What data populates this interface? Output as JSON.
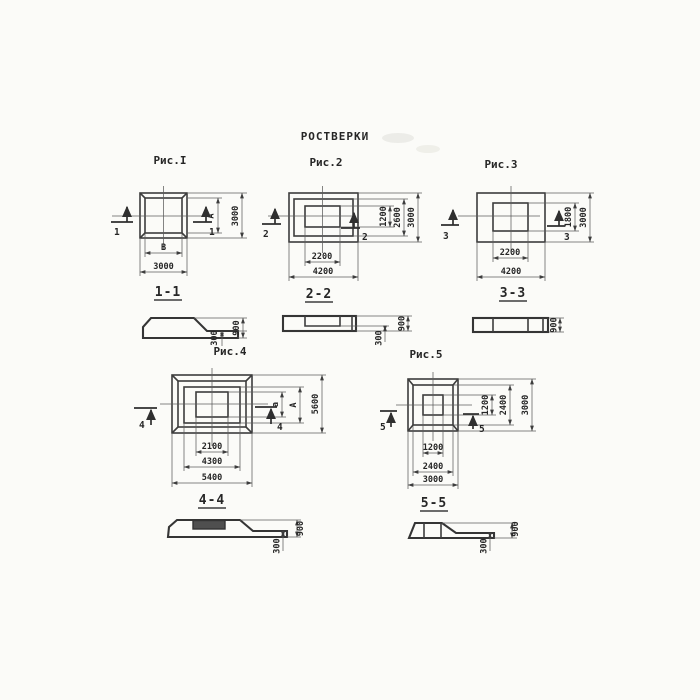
{
  "title": "РОСТВЕРКИ",
  "palette": {
    "paper": "#fbfbf8",
    "ink": "#3d3d3d"
  },
  "fig1": {
    "caption": "Рис.I",
    "section_title": "1-1",
    "cut_left": "1",
    "cut_right": "1",
    "dim_right_inner": "А",
    "dim_right_outer": "3000",
    "dim_bottom_inner": "В",
    "dim_bottom_outer": "3000",
    "sec_step": "300",
    "sec_height": "900"
  },
  "fig2": {
    "caption": "Рис.2",
    "section_title": "2-2",
    "cut_left": "2",
    "cut_right": "2",
    "dim_right_socket": "1200",
    "dim_right_step": "2600",
    "dim_right_outer": "3000",
    "dim_bottom_socket": "2200",
    "dim_bottom_outer": "4200",
    "sec_step": "300",
    "sec_height": "900"
  },
  "fig3": {
    "caption": "Рис.3",
    "section_title": "3-3",
    "cut_left": "3",
    "cut_right": "3",
    "dim_right_socket": "1800",
    "dim_right_outer": "3000",
    "dim_bottom_socket": "2200",
    "dim_bottom_outer": "4200",
    "sec_height": "900"
  },
  "fig4": {
    "caption": "Рис.4",
    "section_title": "4-4",
    "cut_left": "4",
    "cut_right": "4",
    "dim_right_socket": "а",
    "dim_right_step": "А",
    "dim_right_outer": "5600",
    "dim_bottom_socket": "2100",
    "dim_bottom_step": "4300",
    "dim_bottom_outer": "5400",
    "sec_step": "300",
    "sec_height": "900"
  },
  "fig5": {
    "caption": "Рис.5",
    "section_title": "5-5",
    "cut_left": "5",
    "cut_right": "5",
    "dim_right_socket": "1200",
    "dim_right_step": "2400",
    "dim_right_outer": "3000",
    "dim_bottom_socket": "1200",
    "dim_bottom_step": "2400",
    "dim_bottom_outer": "3000",
    "sec_step": "300",
    "sec_height": "900"
  }
}
